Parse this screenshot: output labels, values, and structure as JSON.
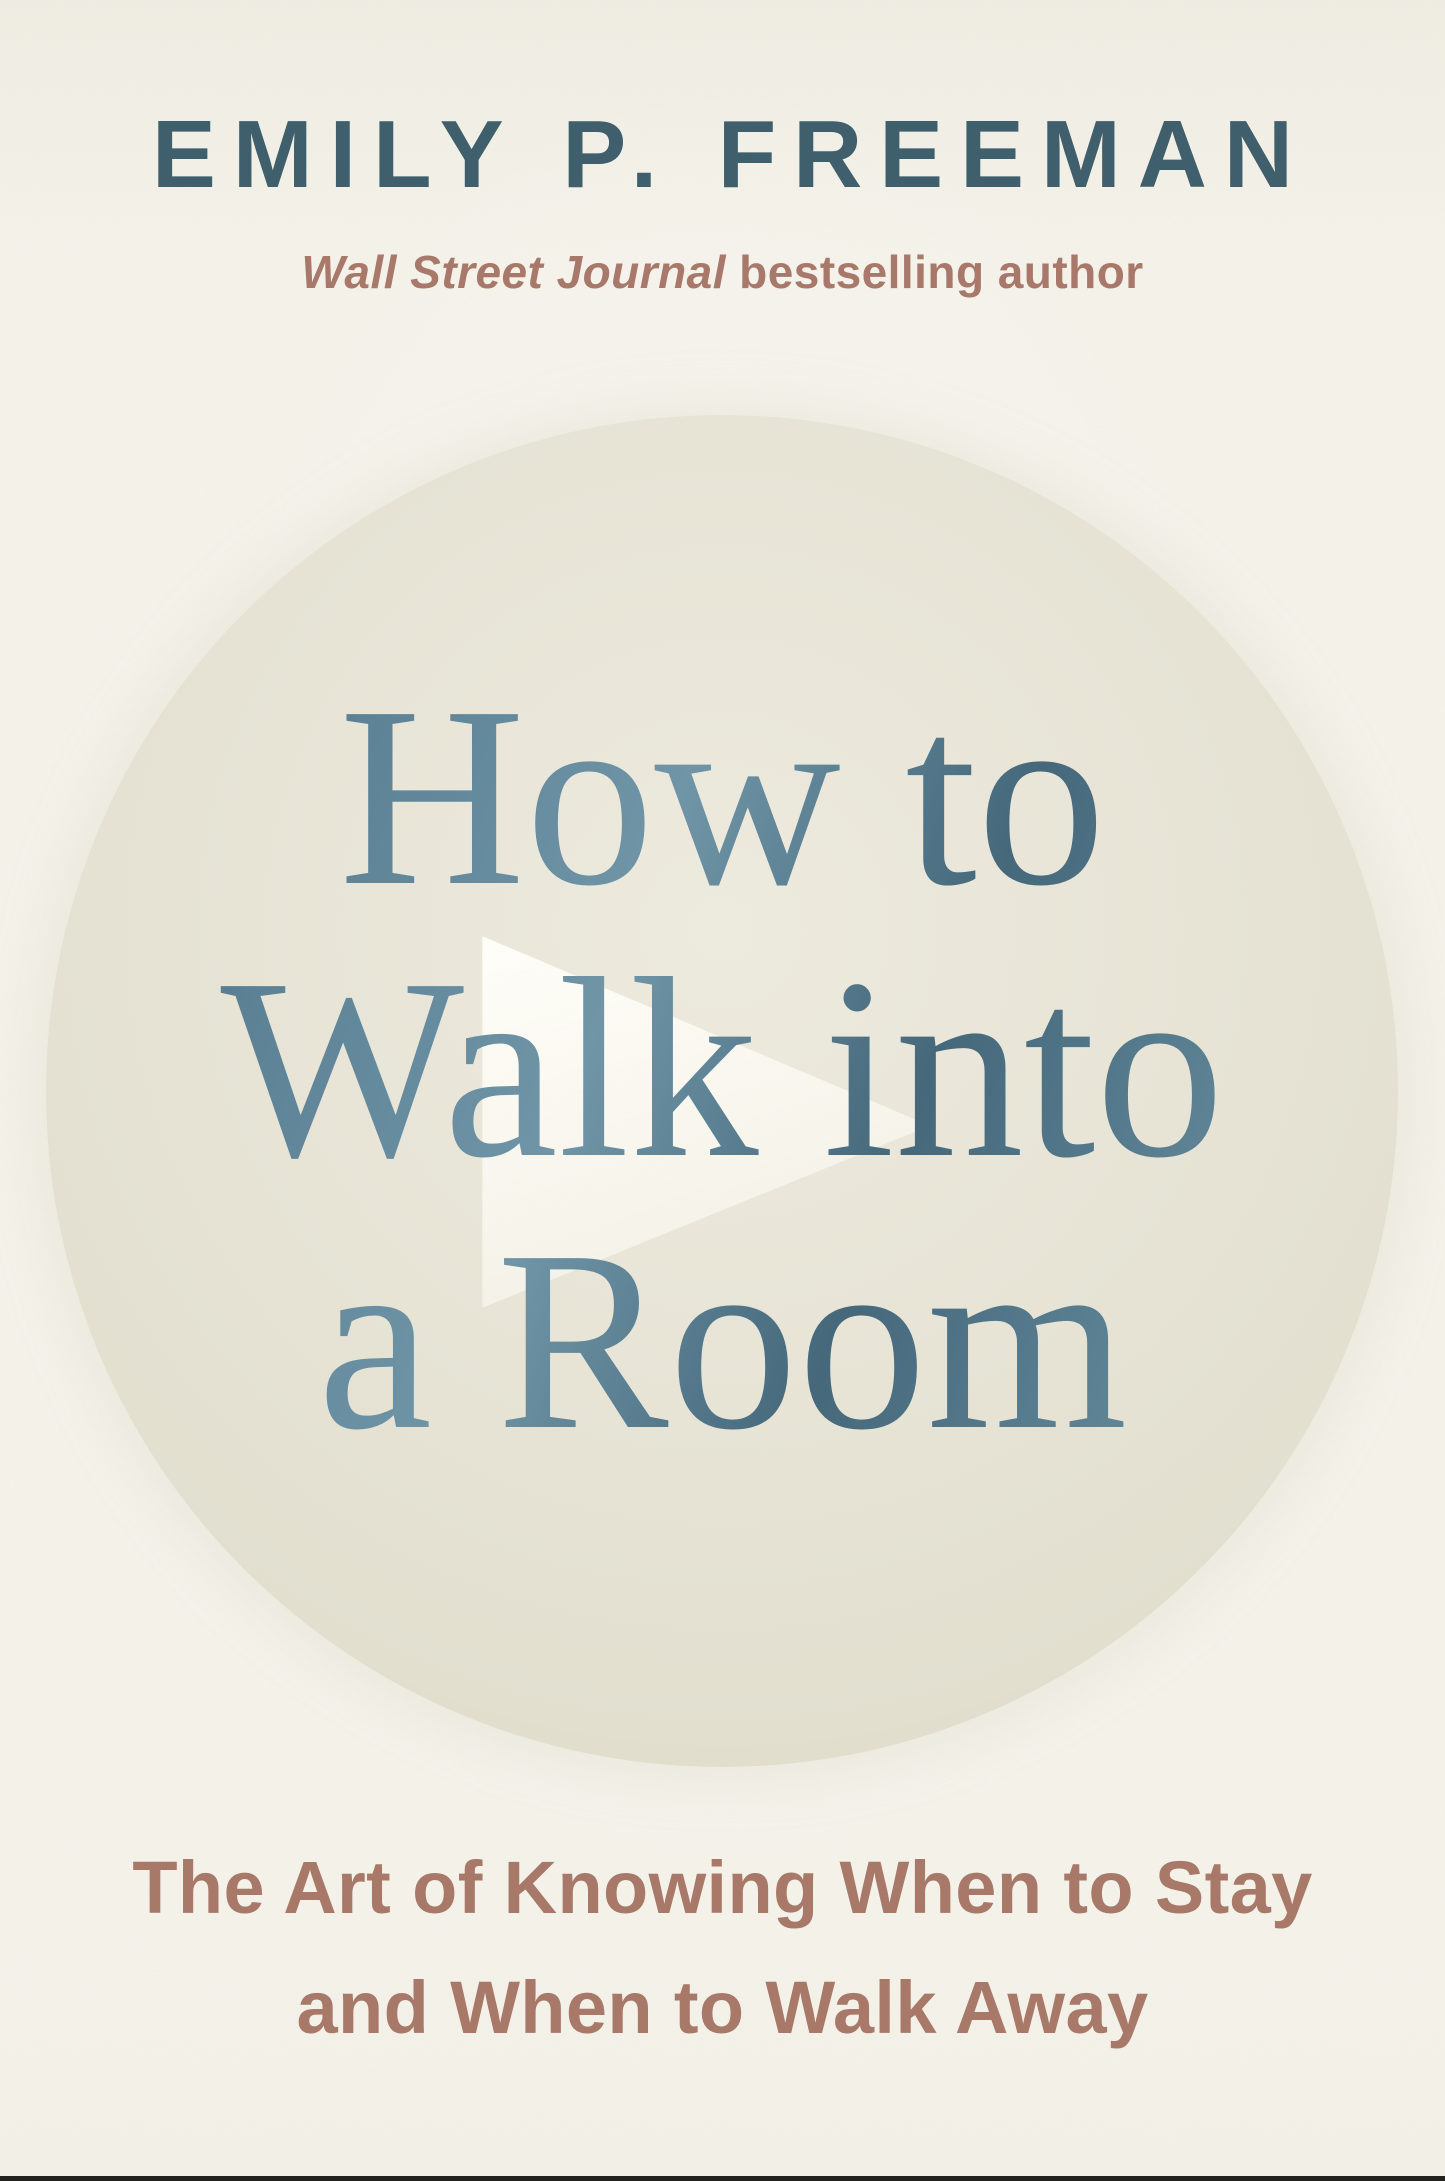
{
  "cover": {
    "author_name": "EMILY P. FREEMAN",
    "credit": {
      "italic_part": "Wall Street Journal",
      "rest_part": " bestselling author"
    },
    "title_lines": [
      "How to",
      "Walk into",
      "a Room"
    ],
    "subtitle_lines": [
      "The Art of Knowing When to Stay",
      "and When to Walk Away"
    ],
    "icons": {
      "arrow_watermark": "right-play-arrow"
    },
    "colors": {
      "background_paper": "#f5f3ea",
      "spotlight_circle": "#e6e3d5",
      "author_slate_blue": "#3e5f6b",
      "title_foil_blue_dark": "#3c5f72",
      "title_foil_blue_light": "#6f95a7",
      "terracotta_accent": "#a87868",
      "arrow_white": "#fcfaf3"
    }
  }
}
